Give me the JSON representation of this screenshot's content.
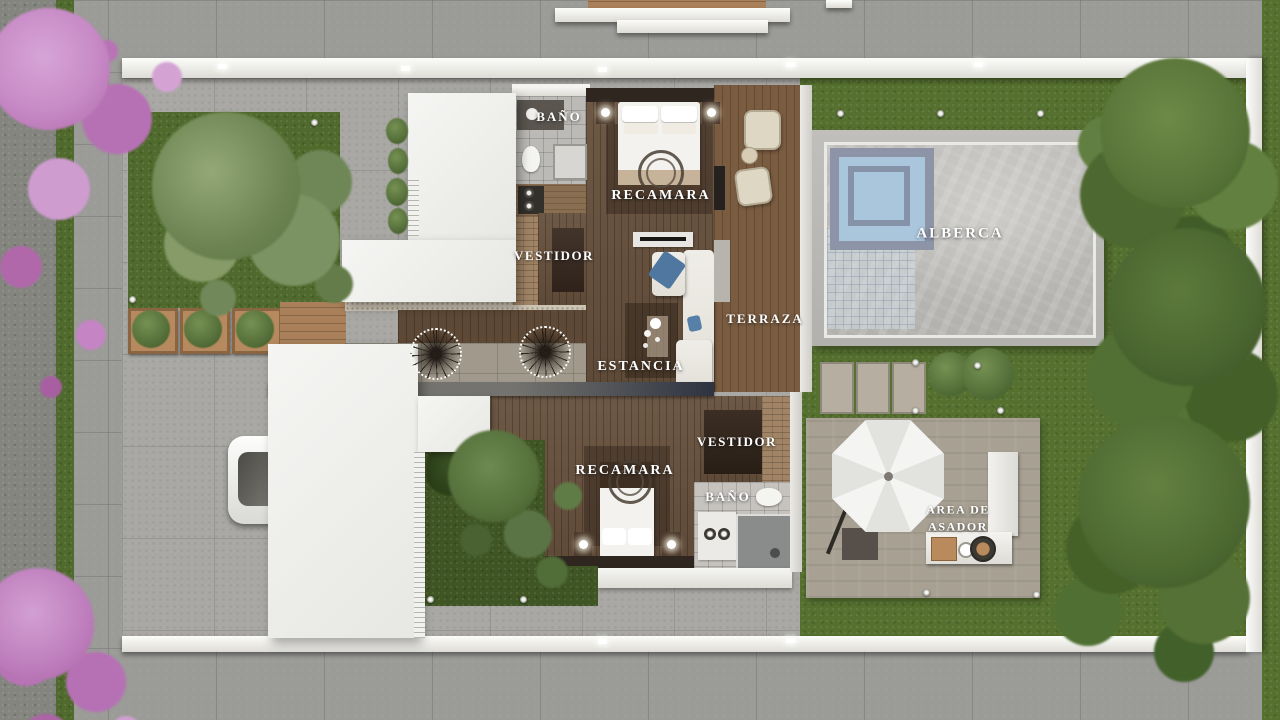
{
  "labels": {
    "upper_bath": "BAÑO",
    "upper_bedroom": "RECAMARA",
    "upper_closet": "VESTIDOR",
    "terrace": "TERRAZA",
    "living_room": "ESTANCIA",
    "pool": "ALBERCA",
    "lower_closet": "VESTIDOR",
    "lower_bedroom": "RECAMARA",
    "lower_bath": "BAÑO",
    "grill_area_line1": "AREA DE",
    "grill_area_line2": "ASADOR"
  },
  "palette": {
    "pavement": "#a9a8a4",
    "street": "#9b9b98",
    "street_dark": "#83857e",
    "lawn": "#4f6a2c",
    "backyard_lawn": "#55702f",
    "tree_green": "#5d7a3b",
    "pink_tree": "#c27fc3",
    "pool_water": "#8fb2d0",
    "wood_floor": "#66503c",
    "terrace_wood": "#7a5c41",
    "roof_white": "#f5f5f3",
    "wall_white": "#fcfcfa",
    "label_text": "#ffffff"
  }
}
